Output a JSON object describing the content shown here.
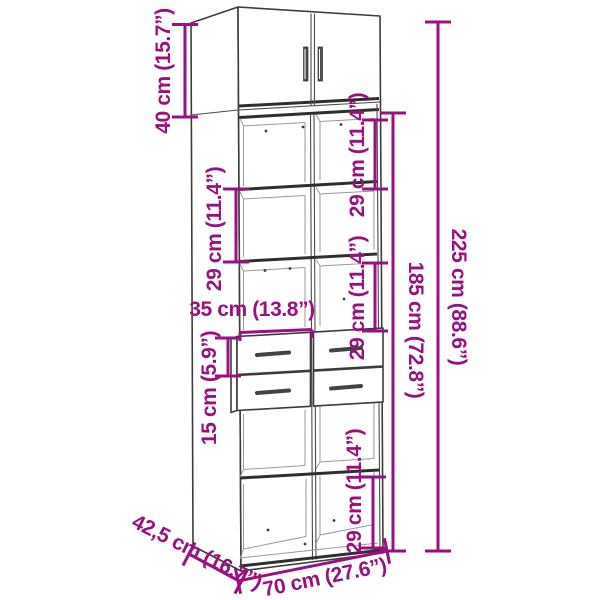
{
  "diagram": {
    "kind": "furniture dimension diagram",
    "subject": "tall cabinet with doors, open shelves and drawers"
  },
  "colors": {
    "dimension_accent": "#9A107E",
    "drawing_line": "#3C3C3C",
    "background": "#FFFFFF"
  },
  "labels": {
    "top_height": "40 cm (15.7”)",
    "shelf_left": "29 cm (11.4”)",
    "shelf_right_upper": "29 cm (11.4”)",
    "shelf_right_middle": "29 cm (11.4”)",
    "shelf_right_lower": "29 cm (11.4”)",
    "half_width": "35 cm (13.8”)",
    "drawer_height": "15 cm (5.9”)",
    "body_height": "185 cm (72.8”)",
    "total_height": "225 cm (88.6”)",
    "depth": "42,5 cm (16.7”)",
    "width": "70 cm (27.6”)"
  }
}
